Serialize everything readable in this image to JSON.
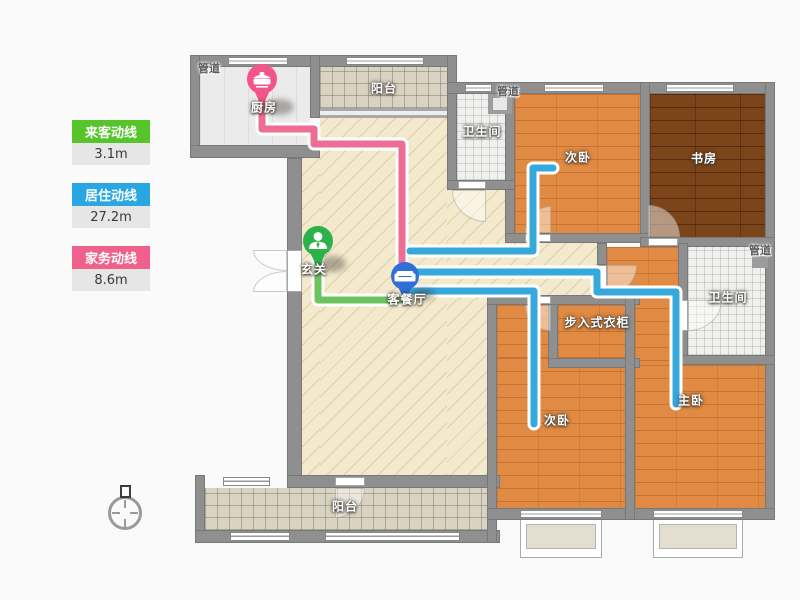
{
  "legend": {
    "items": [
      {
        "label": "来客动线",
        "value": "3.1m",
        "color": "#56c52c"
      },
      {
        "label": "居住动线",
        "value": "27.2m",
        "color": "#2aa7e2"
      },
      {
        "label": "家务动线",
        "value": "8.6m",
        "color": "#f0608c"
      }
    ]
  },
  "plan": {
    "rooms": {
      "duct1": {
        "label": "管道"
      },
      "kitchen": {
        "label": "厨房"
      },
      "balcony_top": {
        "label": "阳台"
      },
      "bath_top": {
        "label": "卫生间"
      },
      "duct2": {
        "label": "管道"
      },
      "bedroom_top": {
        "label": "次卧"
      },
      "study": {
        "label": "书房"
      },
      "duct3": {
        "label": "管道"
      },
      "bath_right": {
        "label": "卫生间"
      },
      "entry": {
        "label": "玄关"
      },
      "living": {
        "label": "客餐厅"
      },
      "closet": {
        "label": "步入式衣柜"
      },
      "bedroom_bottom": {
        "label": "次卧"
      },
      "master": {
        "label": "主卧"
      },
      "balcony_bottom": {
        "label": "阳台"
      }
    },
    "markers": [
      {
        "name": "kitchen-pin",
        "icon": "pot-icon",
        "color": "#f3558b"
      },
      {
        "name": "entry-pin",
        "icon": "person-icon",
        "color": "#2db14a"
      },
      {
        "name": "living-pin",
        "icon": "sofa-icon",
        "color": "#2f6fd6"
      }
    ]
  },
  "colors": {
    "wall": "#8f8f8f",
    "visitor_path": "#6cc45e",
    "resident_path": "#35a8dc",
    "household_path": "#ee6d93",
    "wood_floor": "#e08a43",
    "dark_wood_floor": "#7c4419",
    "beige_floor": "#f3e9cc"
  }
}
